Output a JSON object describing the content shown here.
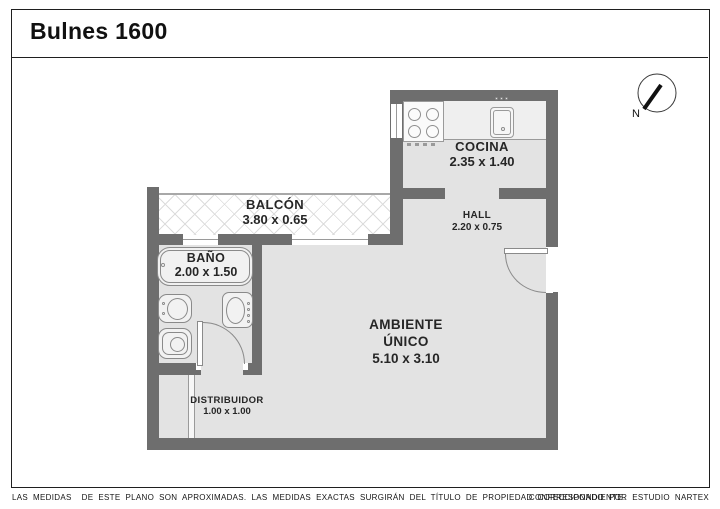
{
  "title": "Bulnes 1600",
  "compass": {
    "north_label": "N"
  },
  "rooms": {
    "cocina": {
      "name": "COCINA",
      "dims": "2.35 x 1.40"
    },
    "balcon": {
      "name": "BALCÓN",
      "dims": "3.80 x 0.65"
    },
    "bano": {
      "name": "BAÑO",
      "dims": "2.00 x 1.50"
    },
    "hall": {
      "name": "HALL",
      "dims": "2.20 x 0.75"
    },
    "ambiente": {
      "name_line1": "AMBIENTE",
      "name_line2": "ÚNICO",
      "dims": "5.10 x 3.10"
    },
    "distribuidor": {
      "name": "DISTRIBUIDOR",
      "dims": "1.00 x 1.00"
    }
  },
  "footer": {
    "disclaimer": "LAS MEDIDAS  DE ESTE PLANO SON APROXIMADAS. LAS MEDIDAS EXACTAS SURGIRÁN DEL TÍTULO DE PROPIEDAD CORRESPONDIENTE.",
    "credit": "CONFECCIONADO POR ESTUDIO NARTEX"
  },
  "colors": {
    "wall": "#6e6e6e",
    "floor": "#e3e3e3",
    "outline": "#8a8a8a",
    "text": "#262626"
  }
}
